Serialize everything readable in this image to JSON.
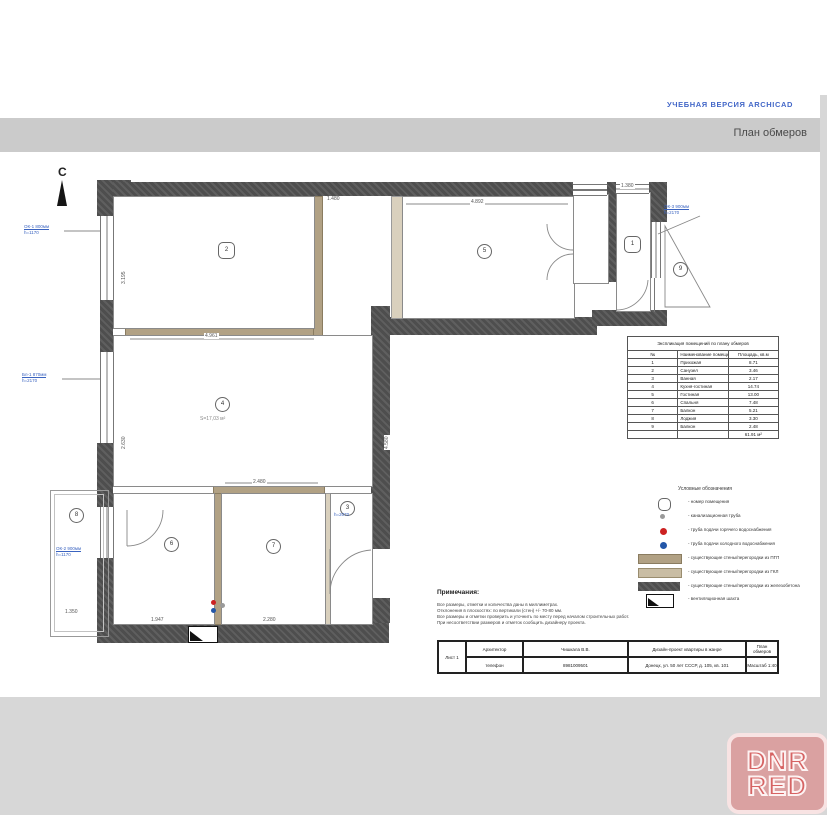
{
  "banner": {
    "trial": "УЧЕБНАЯ ВЕРСИЯ ARCHICAD",
    "title": "План обмеров"
  },
  "north": {
    "label": "С"
  },
  "plan": {
    "area_label": "S=17,03 м²",
    "window_labels": [
      {
        "l1": "ОК-1 800мм",
        "l2": "h=1170"
      },
      {
        "l1": "Бл-1 870мм",
        "l2": "h=2170"
      },
      {
        "l1": "ОК-2 900мм",
        "l2": "h=1170"
      },
      {
        "l1": "ОК-3 900мм",
        "l2": "h=2170"
      },
      {
        "l1": "h=2070",
        "l2": ""
      }
    ],
    "rooms": [
      {
        "num": "1"
      },
      {
        "num": "2"
      },
      {
        "num": "3"
      },
      {
        "num": "4"
      },
      {
        "num": "5"
      },
      {
        "num": "6"
      },
      {
        "num": "7"
      },
      {
        "num": "8"
      },
      {
        "num": "9"
      }
    ],
    "dims": [
      {
        "text": "4.961"
      },
      {
        "text": "4.892"
      },
      {
        "text": "2.480"
      },
      {
        "text": "1.947"
      },
      {
        "text": "2.280"
      },
      {
        "text": "1.350"
      },
      {
        "text": "1.380"
      },
      {
        "text": "1.480"
      },
      {
        "text": "4.580"
      },
      {
        "text": "3.195"
      },
      {
        "text": "2.630"
      }
    ]
  },
  "table": {
    "title": "Экспликация помещений по плану обмеров",
    "headers": [
      "№",
      "Наименование помещения",
      "Площадь, кв.м"
    ],
    "rows": [
      [
        "1",
        "Прихожая",
        "8.71"
      ],
      [
        "2",
        "Санузел",
        "3.46"
      ],
      [
        "3",
        "Ванная",
        "2.17"
      ],
      [
        "4",
        "Кухня-гостиная",
        "14.74"
      ],
      [
        "5",
        "Гостиная",
        "13.00"
      ],
      [
        "6",
        "Спальня",
        "7.48"
      ],
      [
        "7",
        "Балкон",
        "5.21"
      ],
      [
        "8",
        "Лоджия",
        "3.30"
      ],
      [
        "9",
        "Балкон",
        "2.48"
      ]
    ],
    "total": "61.91 м²"
  },
  "legend": {
    "title": "Условные обозначения",
    "items": [
      {
        "icon": "room-number-icon",
        "label": "номер помещения"
      },
      {
        "icon": "sewer-pipe-icon",
        "label": "канализационная труба"
      },
      {
        "icon": "hot-water-icon",
        "label": "труба подачи горячего водоснабжения"
      },
      {
        "icon": "cold-water-icon",
        "label": "труба подачи холодного водоснабжения"
      },
      {
        "icon": "pgp-wall-swatch",
        "label": "существующие стены/перегородки из ПГП"
      },
      {
        "icon": "gkl-wall-swatch",
        "label": "существующие стены/перегородки из ГКЛ"
      },
      {
        "icon": "concrete-wall-swatch",
        "label": "существующие стены/перегородки из железобетона"
      },
      {
        "icon": "vent-shaft-icon",
        "label": "вентиляционная шахта"
      }
    ]
  },
  "notes": {
    "title": "Примечания:",
    "lines": [
      "Все размеры, отметки и количества даны в миллиметрах.",
      "Отклонения в плоскостях: по вертикали (стен) +/- 70-80 мм.",
      "Все размеры и отметки проверить и уточнить по месту перед началом строительных работ.",
      "При несоответствии размеров и отметок сообщить дизайнеру проекта."
    ]
  },
  "titleblock": {
    "r1c1": "Архитектор",
    "r1c2": "Чишкала В.В.",
    "r1c3": "Дизайн-проект квартиры в жанре",
    "r1c4": "План обмеров",
    "r2c1": "телефон",
    "r2c2": "8981009501",
    "r2c3": "Донецк, ул. 50 лет СССР, д. 105, кв. 101",
    "r2c4": "Масштаб 1:40",
    "sheet": "Лист 1"
  },
  "watermark": {
    "line1": "DNR",
    "line2": "RED"
  }
}
